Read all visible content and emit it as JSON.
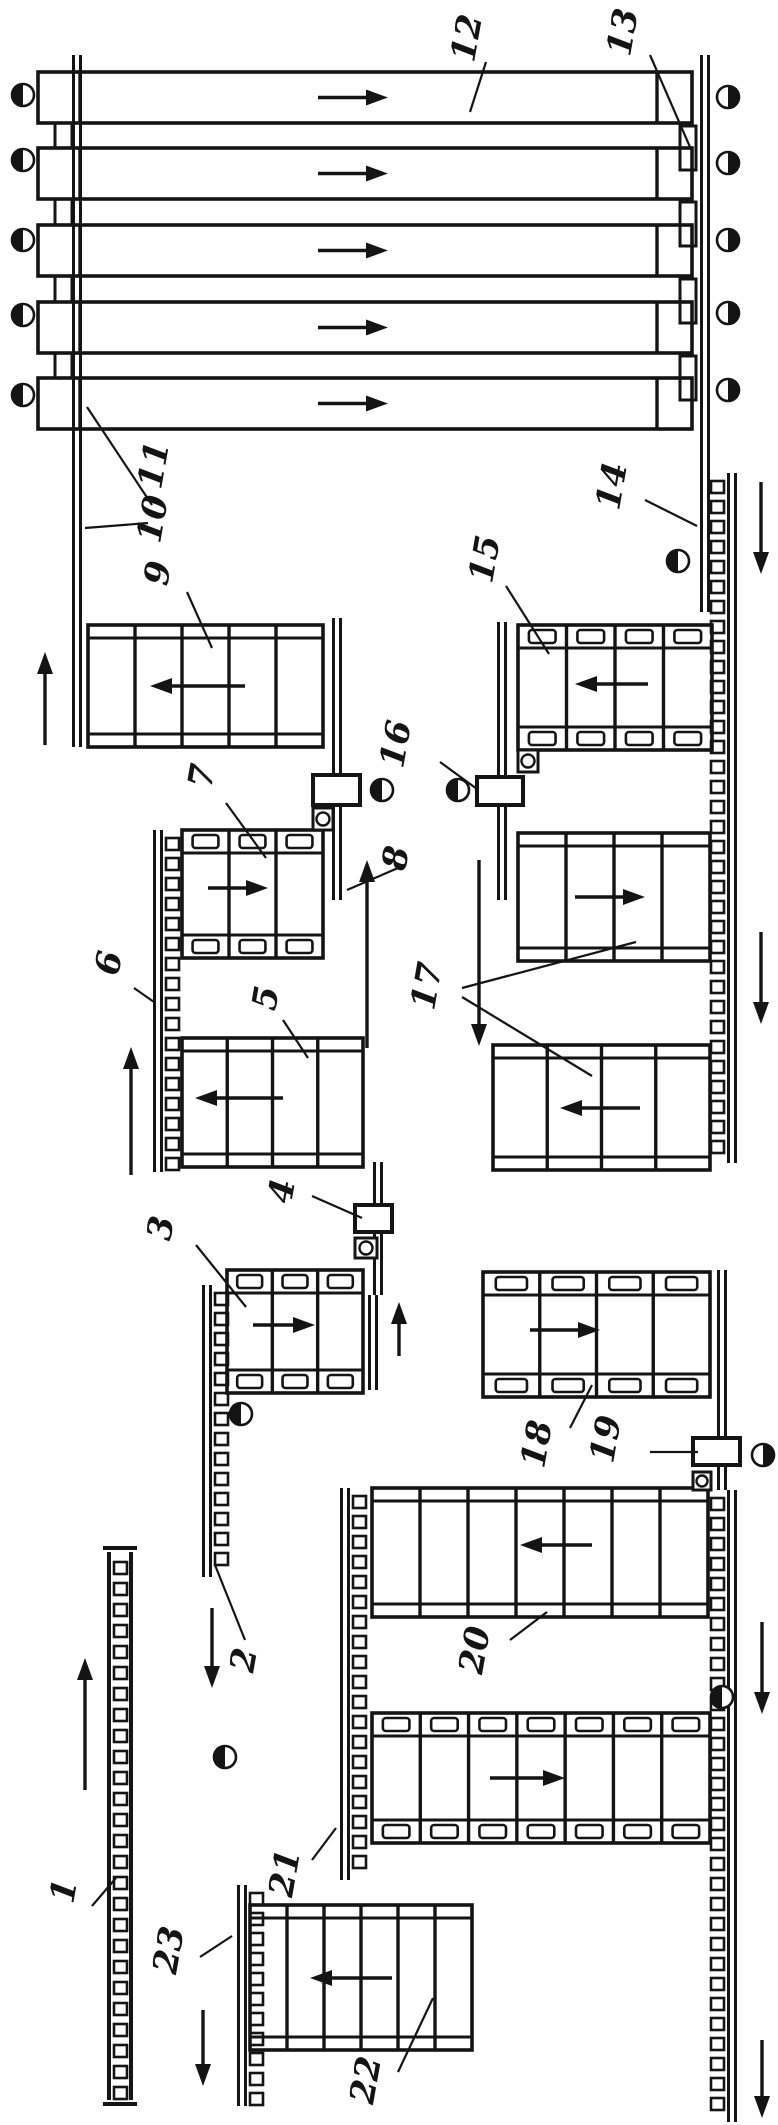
{
  "figure": {
    "width": 778,
    "height": 2125,
    "ink": "#141414",
    "background": "#ffffff",
    "description": "Flow diagram of a sorting / conveyor transport line with numbered positions 1-23"
  },
  "top_sorter": {
    "name": "sorter-deck-12",
    "x": 38,
    "w": 654,
    "h": 51,
    "ys": [
      72,
      148,
      225,
      302,
      378
    ],
    "div_left": 80,
    "div_right": 657,
    "arrow_x1": 318,
    "arrow_x2": 388,
    "left_steps": [
      [
        55,
        123,
        17,
        25
      ],
      [
        55,
        199,
        17,
        26
      ],
      [
        55,
        276,
        17,
        26
      ],
      [
        55,
        353,
        17,
        25
      ]
    ],
    "right_steps": [
      [
        680,
        126,
        16,
        44
      ],
      [
        680,
        202,
        16,
        44
      ],
      [
        680,
        279,
        16,
        44
      ],
      [
        680,
        356,
        16,
        44
      ]
    ]
  },
  "rails": [
    {
      "name": "rail-10",
      "x": 72,
      "y1": 55,
      "y2": 747
    },
    {
      "name": "rail-13-14",
      "x": 700,
      "y1": 55,
      "y2": 612
    },
    {
      "name": "rail-8",
      "x": 332,
      "y1": 618,
      "y2": 900
    },
    {
      "name": "rail-16",
      "x": 497,
      "y1": 622,
      "y2": 900
    },
    {
      "name": "rail-4",
      "x": 373,
      "y1": 1162,
      "y2": 1295
    },
    {
      "name": "rail-3-right",
      "x": 368,
      "y1": 1295,
      "y2": 1390
    },
    {
      "name": "rail-19",
      "x": 717,
      "y1": 1270,
      "y2": 1490
    }
  ],
  "chains": [
    {
      "name": "chain-6",
      "x": 153,
      "y1": 830,
      "y2": 1172,
      "side": "right",
      "type": "rail"
    },
    {
      "name": "chain-2",
      "x": 202,
      "y1": 1285,
      "y2": 1577,
      "side": "right",
      "type": "rail"
    },
    {
      "name": "chain-right-upper-14",
      "x": 727,
      "y1": 473,
      "y2": 1163,
      "side": "left",
      "type": "rail"
    },
    {
      "name": "chain-right-lower",
      "x": 727,
      "y1": 1490,
      "y2": 2122,
      "side": "left",
      "type": "rail"
    },
    {
      "name": "chain-center",
      "x": 340,
      "y1": 1488,
      "y2": 1880,
      "side": "right",
      "type": "rail"
    },
    {
      "name": "chain-23",
      "x": 237,
      "y1": 1885,
      "y2": 2106,
      "side": "right",
      "type": "rail"
    },
    {
      "name": "chain-1",
      "x": 107,
      "y1": 1552,
      "y2": 2100,
      "side": "inside",
      "type": "wide"
    }
  ],
  "conveyors": [
    {
      "name": "conveyor-9",
      "kind": "slat",
      "x": 88,
      "y": 625,
      "w": 235,
      "h": 122,
      "panels": 5,
      "arrow": {
        "x1": 245,
        "y": 686,
        "x2": 150
      }
    },
    {
      "name": "conveyor-7",
      "kind": "plate",
      "x": 182,
      "y": 830,
      "w": 141,
      "h": 128,
      "panels": 3,
      "arrow": {
        "x1": 208,
        "y": 888,
        "x2": 268
      }
    },
    {
      "name": "conveyor-5",
      "kind": "slat",
      "x": 182,
      "y": 1038,
      "w": 181,
      "h": 129,
      "panels": 4,
      "arrow": {
        "x1": 283,
        "y": 1098,
        "x2": 195
      }
    },
    {
      "name": "conveyor-3",
      "kind": "plate",
      "x": 227,
      "y": 1270,
      "w": 136,
      "h": 123,
      "panels": 3,
      "arrow": {
        "x1": 253,
        "y": 1325,
        "x2": 315
      }
    },
    {
      "name": "conveyor-15",
      "kind": "plate",
      "x": 518,
      "y": 625,
      "w": 194,
      "h": 125,
      "panels": 4,
      "arrow": {
        "x1": 648,
        "y": 684,
        "x2": 575
      }
    },
    {
      "name": "conveyor-17-upper",
      "kind": "slat",
      "x": 518,
      "y": 833,
      "w": 192,
      "h": 128,
      "panels": 4,
      "arrow": {
        "x1": 575,
        "y": 897,
        "x2": 645
      }
    },
    {
      "name": "conveyor-17-lower",
      "kind": "slat",
      "x": 493,
      "y": 1045,
      "w": 217,
      "h": 125,
      "panels": 4,
      "arrow": {
        "x1": 640,
        "y": 1108,
        "x2": 560
      }
    },
    {
      "name": "conveyor-18",
      "kind": "plate",
      "x": 483,
      "y": 1272,
      "w": 227,
      "h": 125,
      "panels": 4,
      "arrow": {
        "x1": 530,
        "y": 1330,
        "x2": 600
      }
    },
    {
      "name": "conveyor-20",
      "kind": "slat",
      "x": 372,
      "y": 1488,
      "w": 336,
      "h": 129,
      "panels": 7,
      "arrow": {
        "x1": 592,
        "y": 1545,
        "x2": 520
      }
    },
    {
      "name": "conveyor-21",
      "kind": "plate",
      "x": 372,
      "y": 1713,
      "w": 338,
      "h": 130,
      "panels": 7,
      "arrow": {
        "x1": 490,
        "y": 1778,
        "x2": 565
      }
    },
    {
      "name": "conveyor-22",
      "kind": "slat",
      "x": 250,
      "y": 1905,
      "w": 222,
      "h": 145,
      "panels": 6,
      "arrow": {
        "x1": 392,
        "y": 1978,
        "x2": 310
      }
    }
  ],
  "boxes": [
    {
      "name": "machine-box-8",
      "x": 313,
      "y": 775,
      "w": 47,
      "h": 30
    },
    {
      "name": "machine-box-16",
      "x": 477,
      "y": 777,
      "w": 46,
      "h": 28
    },
    {
      "name": "machine-box-4",
      "x": 355,
      "y": 1205,
      "w": 37,
      "h": 27
    },
    {
      "name": "machine-box-19",
      "x": 693,
      "y": 1438,
      "w": 47,
      "h": 27
    }
  ],
  "square_circles": [
    {
      "name": "bearing-block",
      "x": 313,
      "y": 808,
      "w": 20,
      "h": 22
    },
    {
      "name": "bearing-block",
      "x": 518,
      "y": 750,
      "w": 20,
      "h": 22
    },
    {
      "name": "bearing-block",
      "x": 355,
      "y": 1238,
      "w": 22,
      "h": 20
    },
    {
      "name": "bearing-block",
      "x": 693,
      "y": 1472,
      "w": 18,
      "h": 18
    }
  ],
  "half_circles": [
    {
      "cx": 23,
      "cy": 95,
      "side": "left"
    },
    {
      "cx": 23,
      "cy": 160,
      "side": "left"
    },
    {
      "cx": 23,
      "cy": 240,
      "side": "left"
    },
    {
      "cx": 23,
      "cy": 315,
      "side": "left"
    },
    {
      "cx": 23,
      "cy": 395,
      "side": "left"
    },
    {
      "cx": 728,
      "cy": 97,
      "side": "right"
    },
    {
      "cx": 728,
      "cy": 163,
      "side": "right"
    },
    {
      "cx": 728,
      "cy": 240,
      "side": "right"
    },
    {
      "cx": 728,
      "cy": 313,
      "side": "right"
    },
    {
      "cx": 728,
      "cy": 390,
      "side": "right"
    },
    {
      "cx": 678,
      "cy": 561,
      "side": "left"
    },
    {
      "cx": 382,
      "cy": 790,
      "side": "left"
    },
    {
      "cx": 458,
      "cy": 790,
      "side": "left"
    },
    {
      "cx": 241,
      "cy": 1414,
      "side": "left"
    },
    {
      "cx": 225,
      "cy": 1757,
      "side": "left"
    },
    {
      "cx": 763,
      "cy": 1455,
      "side": "right"
    },
    {
      "cx": 722,
      "cy": 1697,
      "side": "left"
    }
  ],
  "flow_arrows": [
    {
      "name": "flow-up",
      "x": 45,
      "y1": 745,
      "y2": 652
    },
    {
      "name": "flow-up",
      "x": 131,
      "y1": 1175,
      "y2": 1047
    },
    {
      "name": "flow-up",
      "x": 85,
      "y1": 1790,
      "y2": 1658
    },
    {
      "name": "flow-up",
      "x": 367,
      "y1": 1048,
      "y2": 860
    },
    {
      "name": "flow-up",
      "x": 399,
      "y1": 1356,
      "y2": 1302
    },
    {
      "name": "flow-down",
      "x": 479,
      "y1": 860,
      "y2": 1046
    },
    {
      "name": "flow-down",
      "x": 761,
      "y1": 482,
      "y2": 574
    },
    {
      "name": "flow-down",
      "x": 761,
      "y1": 932,
      "y2": 1024
    },
    {
      "name": "flow-down",
      "x": 762,
      "y1": 1622,
      "y2": 1714
    },
    {
      "name": "flow-down",
      "x": 762,
      "y1": 2040,
      "y2": 2118
    },
    {
      "name": "flow-down",
      "x": 212,
      "y1": 1608,
      "y2": 1688
    },
    {
      "name": "flow-down",
      "x": 203,
      "y1": 2010,
      "y2": 2086
    }
  ],
  "labels": [
    {
      "text": "1",
      "x": 75,
      "y": 1893,
      "leaders": [
        [
          92,
          1906,
          116,
          1878
        ]
      ]
    },
    {
      "text": "2",
      "x": 255,
      "y": 1662,
      "leaders": [
        [
          245,
          1640,
          215,
          1565
        ]
      ]
    },
    {
      "text": "3",
      "x": 172,
      "y": 1230,
      "leaders": [
        [
          196,
          1245,
          246,
          1307
        ]
      ]
    },
    {
      "text": "4",
      "x": 293,
      "y": 1193,
      "leaders": [
        [
          312,
          1196,
          362,
          1218
        ]
      ]
    },
    {
      "text": "5",
      "x": 277,
      "y": 1000,
      "leaders": [
        [
          283,
          1020,
          308,
          1058
        ]
      ]
    },
    {
      "text": "6",
      "x": 120,
      "y": 965,
      "leaders": [
        [
          134,
          988,
          154,
          1002
        ]
      ]
    },
    {
      "text": "7",
      "x": 213,
      "y": 778,
      "leaders": [
        [
          226,
          803,
          266,
          858
        ]
      ]
    },
    {
      "text": "8",
      "x": 407,
      "y": 860,
      "leaders": [
        [
          398,
          868,
          347,
          890
        ]
      ]
    },
    {
      "text": "9",
      "x": 169,
      "y": 575,
      "leaders": [
        [
          187,
          592,
          212,
          648
        ]
      ]
    },
    {
      "text": "10",
      "x": 164,
      "y": 521,
      "leaders": [
        [
          148,
          523,
          85,
          528
        ]
      ]
    },
    {
      "text": "11",
      "x": 165,
      "y": 467,
      "leaders": [
        [
          152,
          505,
          87,
          407
        ]
      ]
    },
    {
      "text": "12",
      "x": 478,
      "y": 40,
      "leaders": [
        [
          486,
          62,
          470,
          112
        ]
      ]
    },
    {
      "text": "13",
      "x": 634,
      "y": 34,
      "leaders": [
        [
          650,
          55,
          690,
          147
        ]
      ]
    },
    {
      "text": "14",
      "x": 623,
      "y": 488,
      "leaders": [
        [
          645,
          500,
          697,
          526
        ]
      ]
    },
    {
      "text": "15",
      "x": 496,
      "y": 561,
      "leaders": [
        [
          506,
          586,
          549,
          654
        ]
      ]
    },
    {
      "text": "16",
      "x": 407,
      "y": 746,
      "leaders": [
        [
          440,
          762,
          477,
          789
        ]
      ]
    },
    {
      "text": "17",
      "x": 438,
      "y": 988,
      "leaders": [
        [
          462,
          988,
          636,
          942
        ],
        [
          462,
          997,
          592,
          1076
        ]
      ]
    },
    {
      "text": "18",
      "x": 548,
      "y": 1446,
      "leaders": [
        [
          570,
          1428,
          592,
          1385
        ]
      ]
    },
    {
      "text": "19",
      "x": 617,
      "y": 1441,
      "leaders": [
        [
          650,
          1452,
          698,
          1452
        ]
      ]
    },
    {
      "text": "20",
      "x": 486,
      "y": 1652,
      "leaders": [
        [
          510,
          1640,
          547,
          1612
        ]
      ]
    },
    {
      "text": "21",
      "x": 296,
      "y": 1875,
      "leaders": [
        [
          312,
          1860,
          336,
          1828
        ]
      ]
    },
    {
      "text": "22",
      "x": 377,
      "y": 2082,
      "leaders": [
        [
          398,
          2072,
          433,
          1998
        ]
      ]
    },
    {
      "text": "23",
      "x": 180,
      "y": 1952,
      "leaders": [
        [
          200,
          1957,
          232,
          1936
        ]
      ]
    }
  ]
}
